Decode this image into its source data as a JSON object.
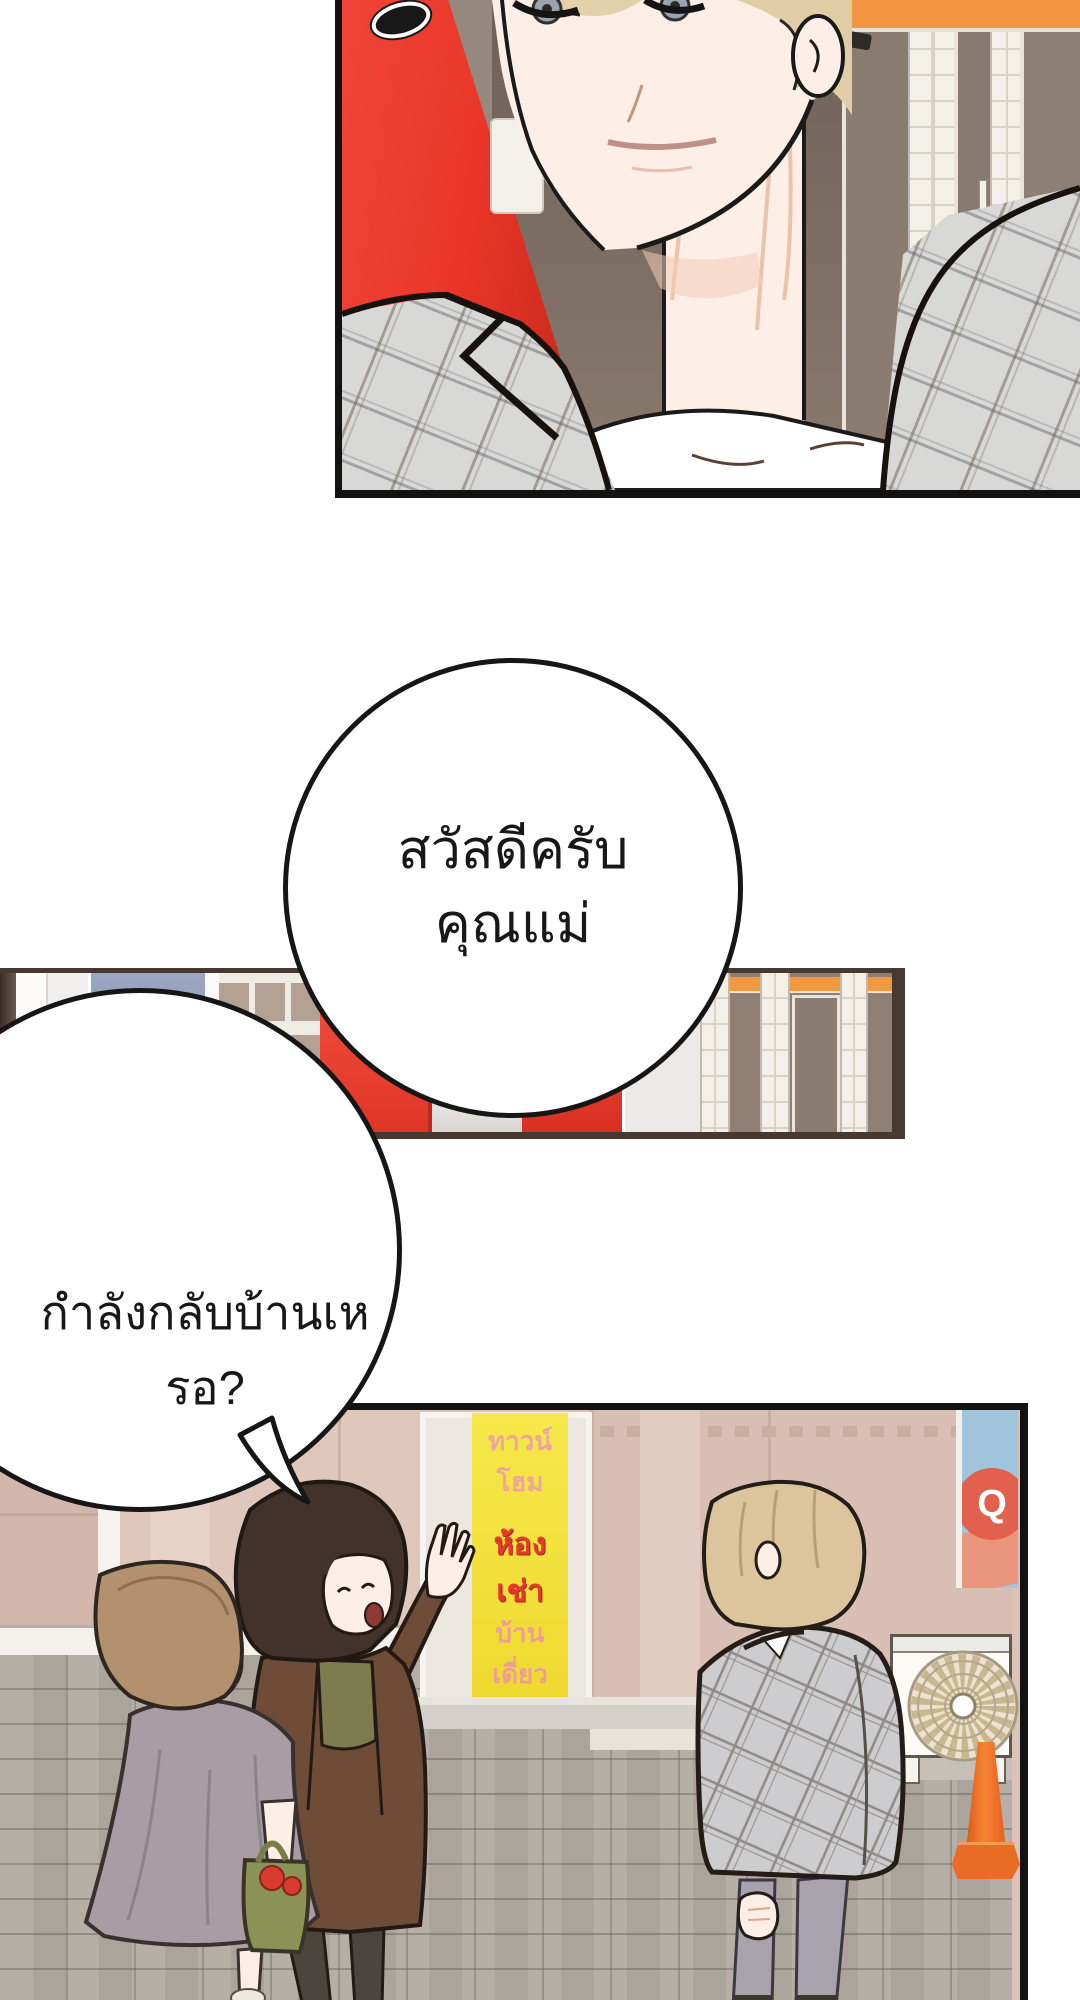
{
  "page": {
    "background": "#ffffff"
  },
  "bubbles": {
    "greeting": {
      "line1": "สวัสดีครับ",
      "line2": "คุณแม่"
    },
    "question": {
      "text": "กำลังกลับบ้านเหรอ?"
    }
  },
  "strip_panel": {
    "blue_sign": {
      "line1": "ของด",
      "line2": "กง"
    }
  },
  "street_panel": {
    "yellow_sign": {
      "line1": "ทาวน์โฮม",
      "line2": "ห้องเช่า",
      "line3": "บ้านเดี่ยว"
    },
    "q_poster": {
      "letter": "Q"
    }
  },
  "colors": {
    "locker_red": "#ee3b2d",
    "accent_orange": "#f2973f",
    "sign_yellow": "#f2e238",
    "sign_blue": "#94a0bc",
    "wall_pink": "#dcc2b6",
    "pavement_gray": "#b0aaa2",
    "coat_brown": "#6f4c38",
    "dress_mauve": "#a89da5",
    "suit_gray": "#cfcfd1",
    "cone_orange": "#ee6a22",
    "panel_border_dark": "#473831",
    "panel_border_black": "#121212"
  }
}
